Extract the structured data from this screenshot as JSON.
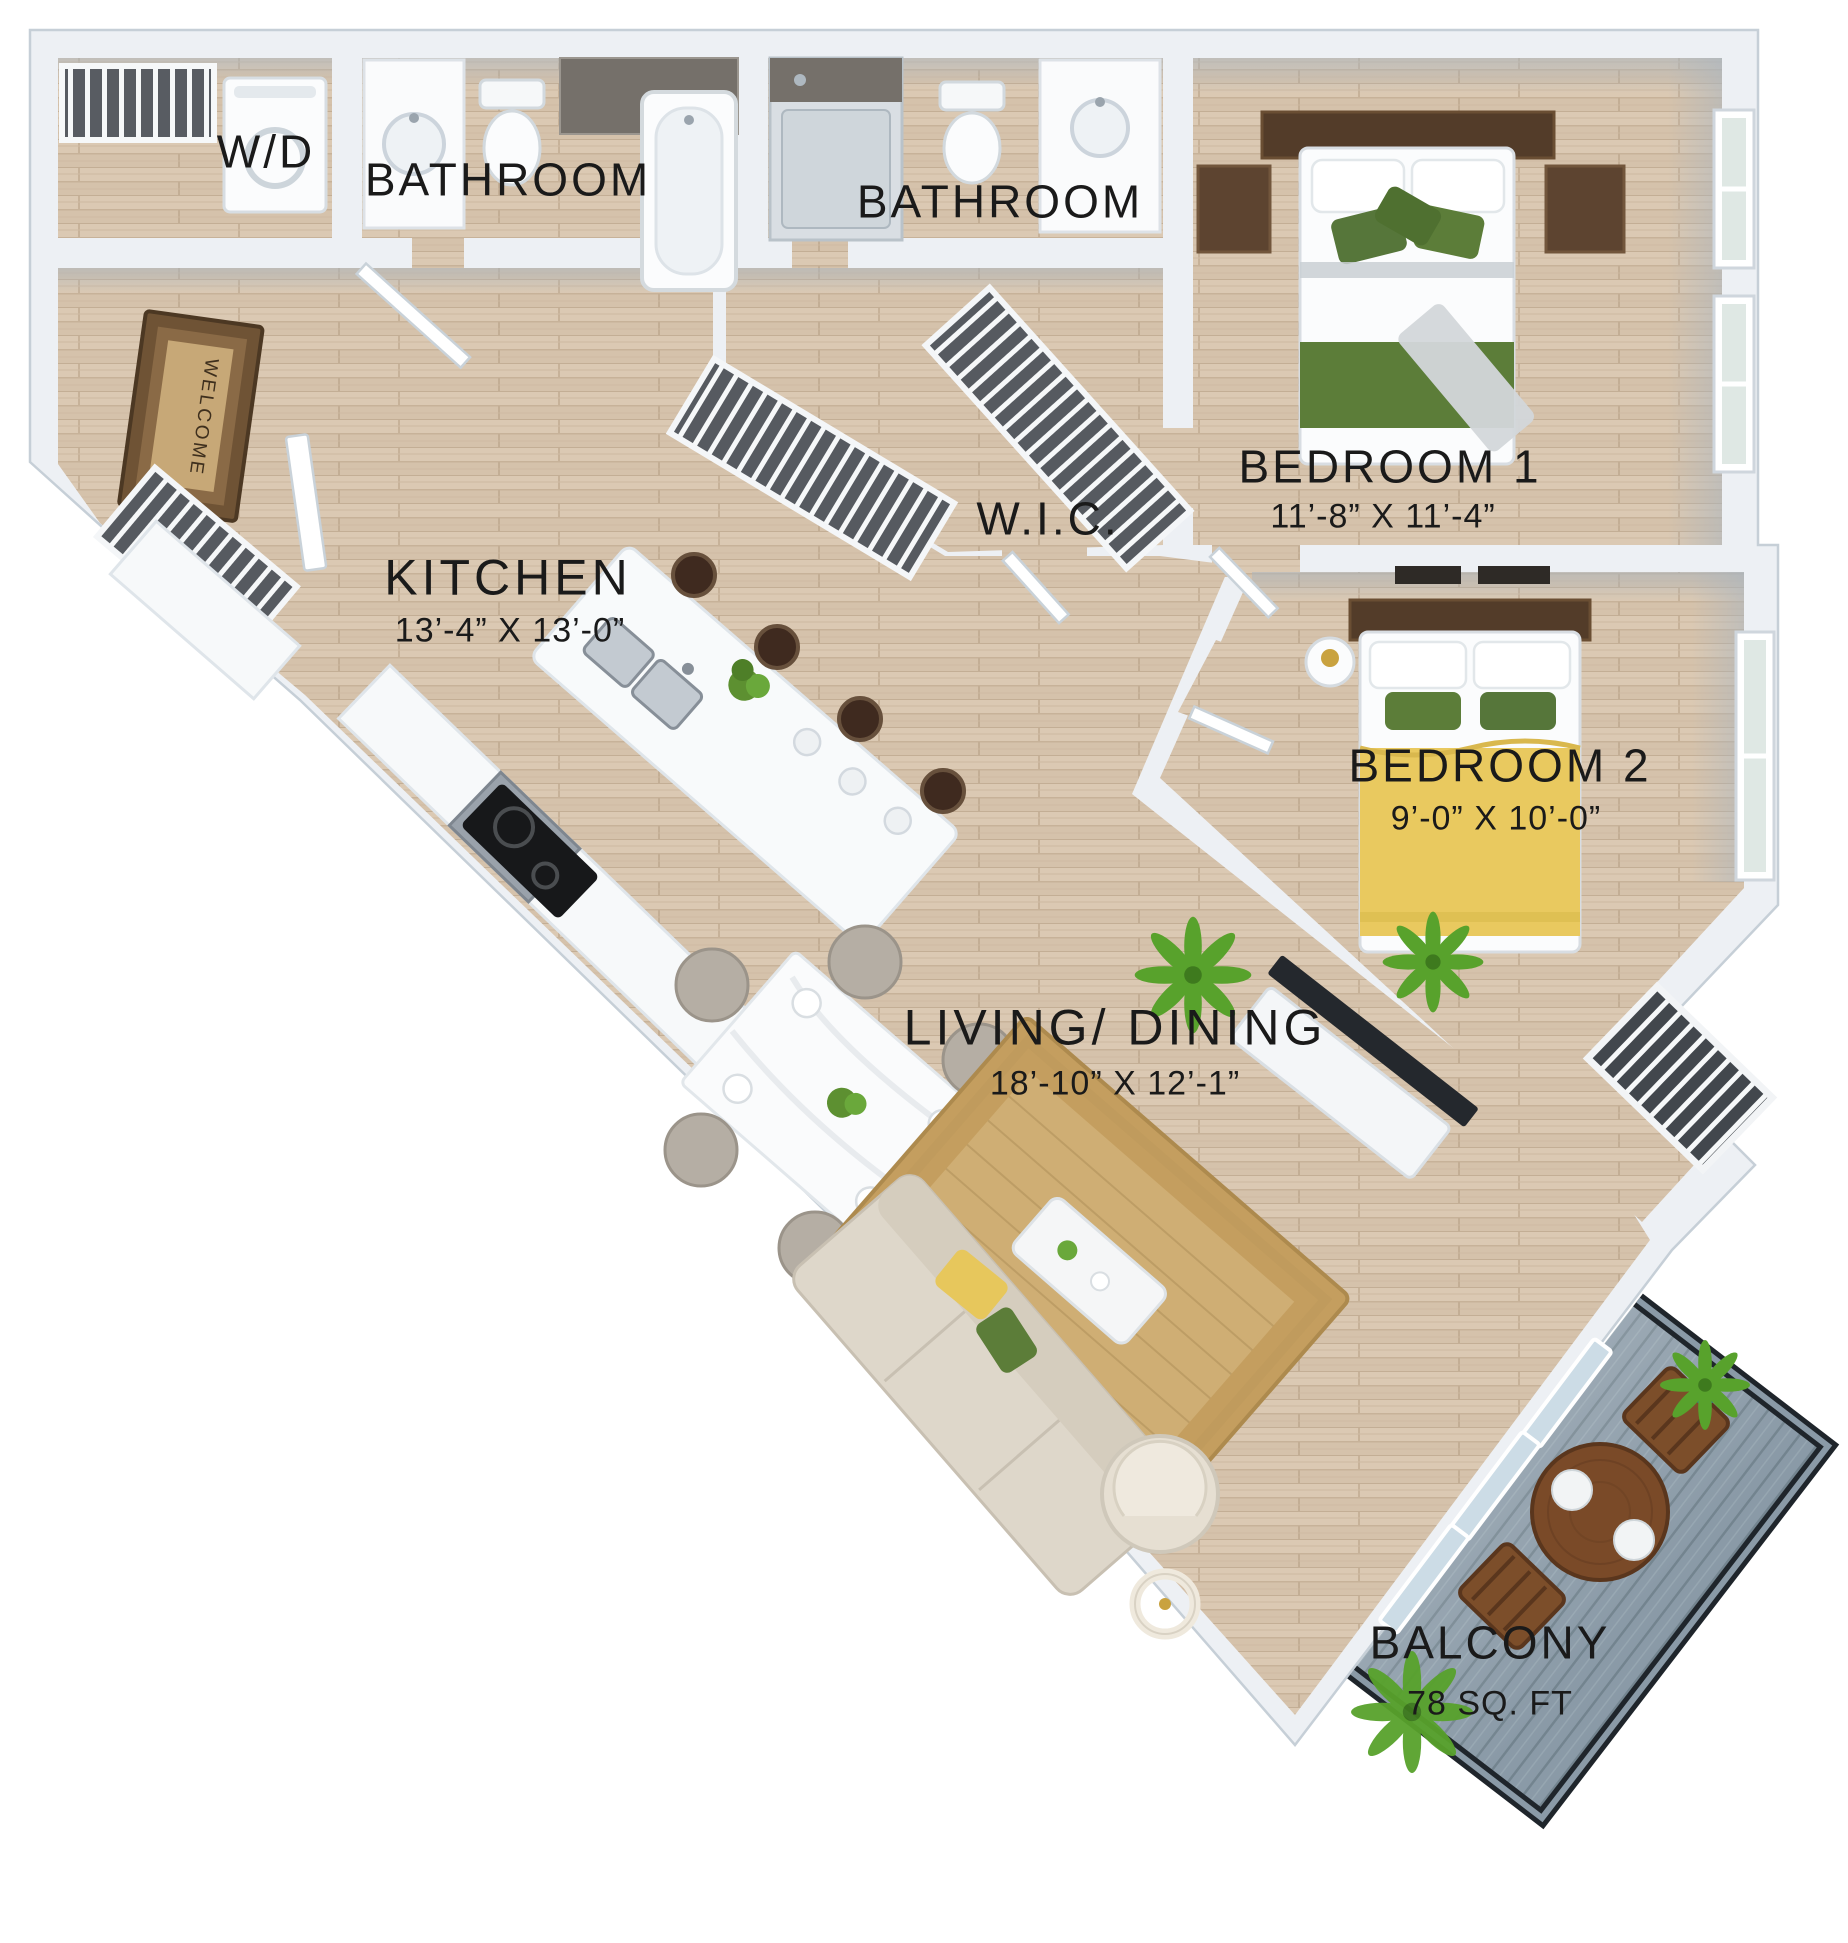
{
  "rooms": {
    "wd": {
      "label": "W/D"
    },
    "bathroom1": {
      "label": "BATHROOM"
    },
    "bathroom2": {
      "label": "BATHROOM"
    },
    "bedroom1": {
      "label": "BEDROOM 1",
      "dims": "11’-8” X 11’-4”"
    },
    "wic": {
      "label": "W.I.C."
    },
    "kitchen": {
      "label": "KITCHEN",
      "dims": "13’-4” X 13’-0”"
    },
    "bedroom2": {
      "label": "BEDROOM 2",
      "dims": "9’-0” X 10’-0”"
    },
    "living": {
      "label": "LIVING/ DINING",
      "dims": "18’-10” X 12’-1”"
    },
    "balcony": {
      "label": "BALCONY",
      "dims": "78 SQ. FT"
    }
  },
  "doormat": {
    "text": "WELCOME"
  },
  "colors": {
    "wall": "#edf0f4",
    "wall_edge": "#c6cfd7",
    "floor_wood": "#d8c6b0",
    "bed1_green": "#5c7d39",
    "bed2_yellow": "#e9c95f",
    "rug_tan": "#c49e5f",
    "sofa_beige": "#ded7ca",
    "balcony_deck": "#8a9aa7",
    "railing": "#1f252b",
    "label_text": "#1a1a1a"
  }
}
